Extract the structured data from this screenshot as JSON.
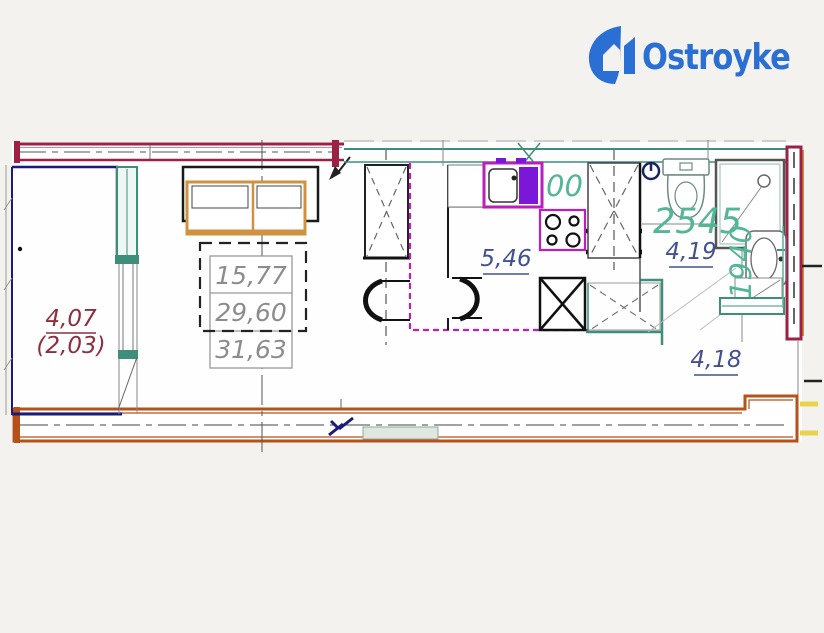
{
  "logo": {
    "text": "Ostroyke",
    "brand_color": "#2a6fd4"
  },
  "plan": {
    "area_table": [
      "15,77",
      "29,60",
      "31,63"
    ],
    "labels": {
      "balcony_area": "4,07",
      "balcony_area_reduced": "(2,03)",
      "kitchen_area": "5,46",
      "bathroom_area": "4,19",
      "hall_area": "4,18",
      "bathroom_width_mm": "2545",
      "bathroom_depth_mm": "1940",
      "dim_fragment": "00"
    },
    "colors": {
      "wall_red": "#9e2144",
      "wall_orange": "#b5521b",
      "balcony_navy": "#1b1b7e",
      "window_teal": "#3d8f7c",
      "dimension_teal": "#53b695",
      "plumbing_magenta": "#bb1fbb",
      "sink_violet": "#7a17d8",
      "label_blue": "#44508f",
      "label_maroon": "#8e2f3e",
      "table_gray": "#8c8c8c",
      "furniture_orange": "#cf9240",
      "accent_yellow": "#e9d34c"
    }
  }
}
